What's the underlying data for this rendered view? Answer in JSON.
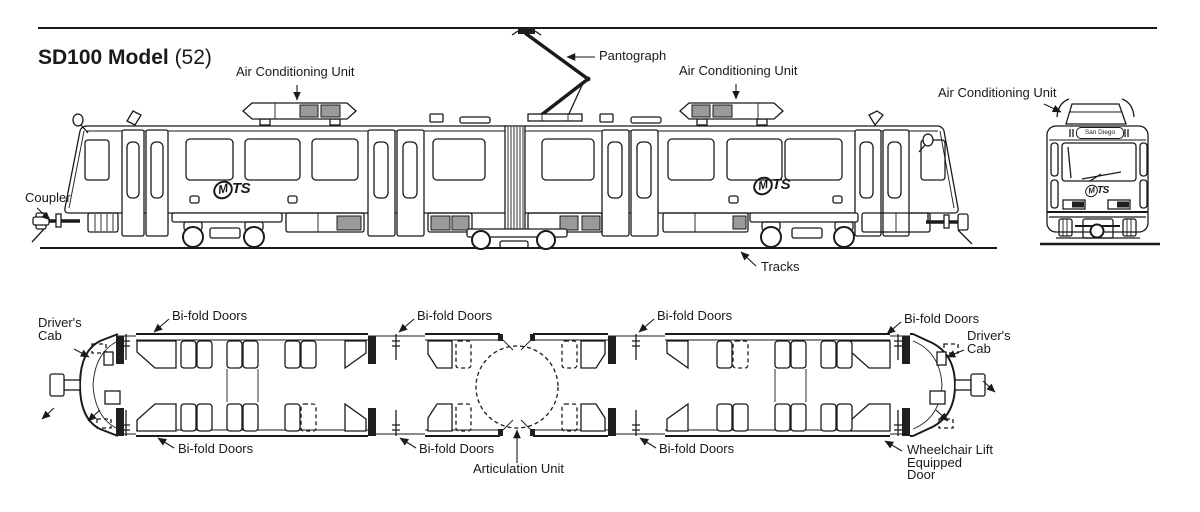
{
  "title": {
    "model": "SD100 Model",
    "count": "(52)"
  },
  "colors": {
    "ink": "#1a1a1a",
    "panel_gray": "#9a9a9a",
    "background": "#ffffff"
  },
  "logos": {
    "mts_m": "M",
    "mts_ts": "TS"
  },
  "side_view": {
    "labels": {
      "air_conditioning_unit_left": "Air Conditioning Unit",
      "pantograph": "Pantograph",
      "air_conditioning_unit_right": "Air Conditioning Unit",
      "coupler": "Coupler",
      "tracks": "Tracks"
    }
  },
  "front_view": {
    "labels": {
      "air_conditioning_unit": "Air Conditioning Unit"
    },
    "destination_sign": "San Diego"
  },
  "floor_plan": {
    "labels": {
      "drivers_cab_left": "Driver's Cab",
      "drivers_cab_right": "Driver's Cab",
      "bifold_top_left": "Bi-fold Doors",
      "bifold_top_mid_left": "Bi-fold Doors",
      "bifold_top_mid_right": "Bi-fold Doors",
      "bifold_top_right": "Bi-fold Doors",
      "bifold_bottom_left": "Bi-fold Doors",
      "bifold_bottom_mid_left": "Bi-fold Doors",
      "bifold_bottom_mid_right": "Bi-fold Doors",
      "articulation_unit": "Articulation Unit",
      "wheelchair_door": "Wheelchair Lift Equipped Door"
    }
  }
}
